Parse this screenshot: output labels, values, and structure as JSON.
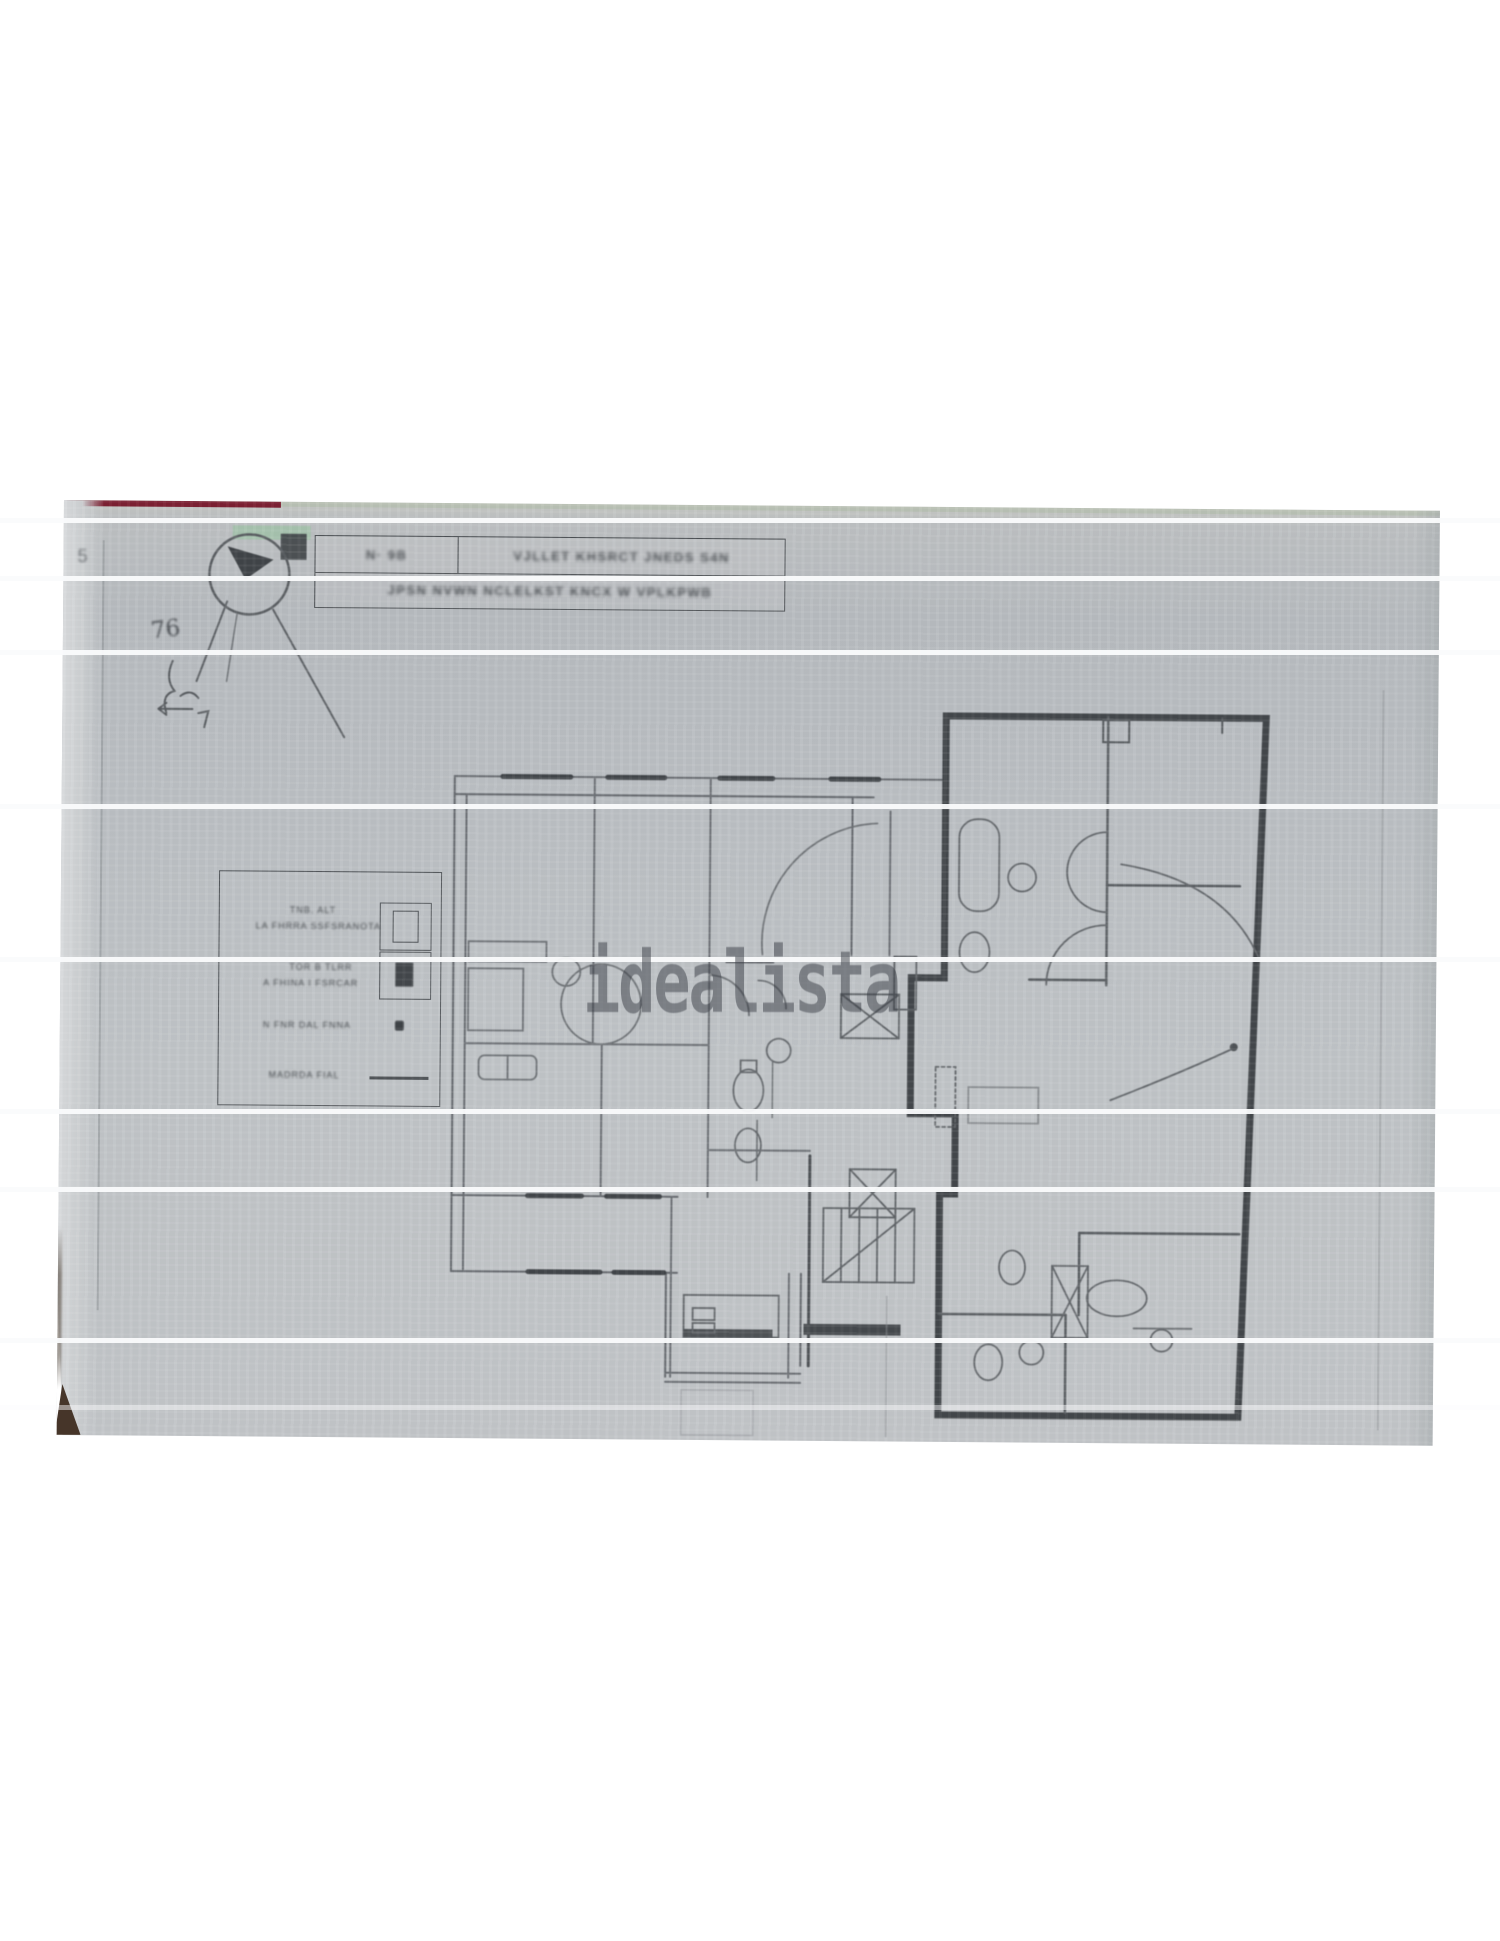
{
  "page": {
    "background": "#ffffff"
  },
  "photo": {
    "paper_color": "#bcc0c4",
    "edge_red": "#7d2133",
    "edge_green": "#a3c3ab",
    "handwritten_number": "76",
    "pencil_mark": "5"
  },
  "title_block": {
    "row1_left": "N· 9B",
    "row1_right": "VJLLET KHSRCT JNEDS S4N",
    "row2": "JPSN NVWN NCLELKST KNCX W VPLKPWB"
  },
  "legend": {
    "items": [
      {
        "line1": "TNB. ALT",
        "line2": "LA FHRRA SSFSRANOTA",
        "symbol": "window-frame-icon"
      },
      {
        "line1": "TOR B TLRR",
        "line2": "A FHINA I FSRCAR",
        "symbol": "window-dark-icon"
      },
      {
        "line1": "N FNR DAL FNNA",
        "symbol": "dot-icon"
      },
      {
        "line1": "MADRDA FIAL",
        "symbol": "line-icon"
      }
    ]
  },
  "watermark": {
    "text": "idealista",
    "color": "rgba(55,60,67,0.5)"
  }
}
